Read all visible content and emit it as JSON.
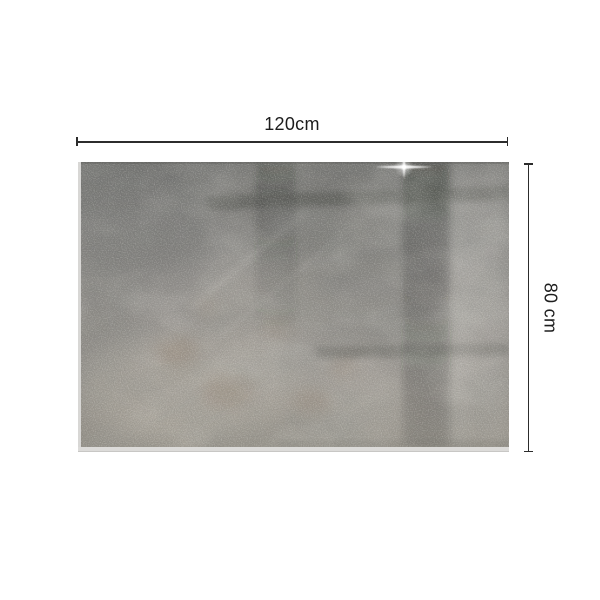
{
  "page": {
    "background": "#ffffff"
  },
  "dimensions": {
    "width_label": "120cm",
    "height_label": "80 cm"
  },
  "icons": {
    "sparkle": "four-point-glint-flare"
  },
  "colors": {
    "page_background": "#ffffff",
    "dimension_line": "#2c2c2c",
    "dimension_text": "#1d1d1d",
    "panel_base_gray": "#8f8d8a",
    "panel_light_gray": "#a5a19a",
    "panel_dark_band": "#34362f",
    "panel_rust": "#8a6f58",
    "glass_edge": "#d8d7d5"
  }
}
